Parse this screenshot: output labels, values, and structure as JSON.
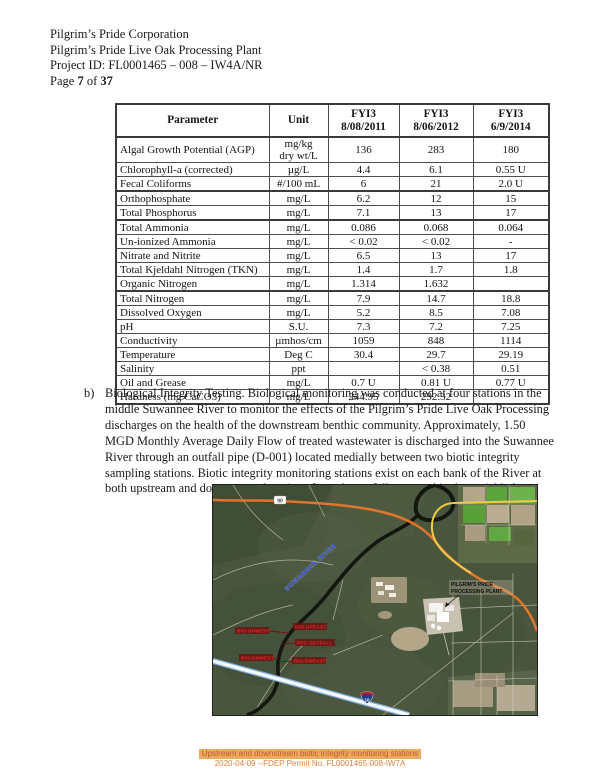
{
  "document": {
    "header_lines": [
      "Pilgrim’s Pride Corporation",
      "Pilgrim’s Pride Live Oak Processing Plant",
      "Project ID: FL0001465 – 008 – IW4A/NR"
    ],
    "page_label": {
      "word_page": "Page",
      "number": "7",
      "word_of": "of",
      "total": "37"
    }
  },
  "table": {
    "columns": [
      {
        "label": "Parameter"
      },
      {
        "label": "Unit"
      },
      {
        "label": "FYI3",
        "sub": "8/08/2011"
      },
      {
        "label": "FYI3",
        "sub": "8/06/2012"
      },
      {
        "label": "FYI3",
        "sub": "6/9/2014"
      }
    ],
    "rows": [
      [
        "Algal Growth Potential (AGP)",
        "mg/kg\ndry wt/L",
        "136",
        "283",
        "180"
      ],
      [
        "Chlorophyll-a (corrected)",
        "µg/L",
        "4.4",
        "6.1",
        "0.55 U"
      ],
      [
        "Fecal Coliforms",
        "#/100 mL",
        "6",
        "21",
        "2.0 U"
      ],
      [
        "Orthophosphate",
        "mg/L",
        "6.2",
        "12",
        "15"
      ],
      [
        "Total Phosphorus",
        "mg/L",
        "7.1",
        "13",
        "17"
      ],
      [
        "Total Ammonia",
        "mg/L",
        "0.086",
        "0.068",
        "0.064"
      ],
      [
        "Un-ionized Ammonia",
        "mg/L",
        "< 0.02",
        "< 0.02",
        "-"
      ],
      [
        "Nitrate and Nitrite",
        "mg/L",
        "6.5",
        "13",
        "17"
      ],
      [
        "Total Kjeldahl Nitrogen (TKN)",
        "mg/L",
        "1.4",
        "1.7",
        "1.8"
      ],
      [
        "Organic Nitrogen",
        "mg/L",
        "1.314",
        "1.632",
        ""
      ],
      [
        "Total Nitrogen",
        "mg/L",
        "7.9",
        "14.7",
        "18.8"
      ],
      [
        "Dissolved Oxygen",
        "mg/L",
        "5.2",
        "8.5",
        "7.08"
      ],
      [
        "pH",
        "S.U.",
        "7.3",
        "7.2",
        "7.25"
      ],
      [
        "Conductivity",
        "µmhos/cm",
        "1059",
        "848",
        "1114"
      ],
      [
        "Temperature",
        "Deg C",
        "30.4",
        "29.7",
        "29.19"
      ],
      [
        "Salinity",
        "ppt",
        "",
        "< 0.38",
        "0.51"
      ],
      [
        "Oil and Grease",
        "mg/L",
        "0.7 U",
        "0.81 U",
        "0.77 U"
      ],
      [
        "Hardness (mg CaCO3)",
        "mg/L",
        "244.95",
        "292.32",
        ""
      ]
    ]
  },
  "body_text": {
    "item_marker": "b)",
    "paragraph": "Biological Integrity Testing.  Biological monitoring was conducted at four stations in the middle Suwannee River to monitor the effects of the Pilgrim’s Pride Live Oak Processing discharges on the health of the downstream benthic community. Approximately, 1.50 MGD Monthly Average Daily Flow of treated wastewater is discharged into the Suwannee River through an outfall pipe (D-001) located medially between two biotic integrity sampling stations. Biotic integrity monitoring stations exist on each bank of the River at both upstream and downstream locations from the outfall, as noted in the aerial below."
  },
  "map": {
    "river_label": "SUWANNEE RIVER",
    "plant_label_line1": "PILGRIM'S PRIDE",
    "plant_label_line2": "PROCESSING PLANT",
    "route_us90": "90",
    "route_i10": "10",
    "stations": [
      {
        "label": "BIO-UPWEST"
      },
      {
        "label": "BIO-UPEAST"
      },
      {
        "label": "PPC OUTFALL"
      },
      {
        "label": "BIO-DNWEST"
      },
      {
        "label": "BIO-DNEAST"
      }
    ]
  },
  "caption": {
    "line1": "Upstream and downstream biotic integrity monitoring stations",
    "line2": "2020-04-09 --FDEP Permit No. FL0001465-008-IW7A"
  },
  "colors": {
    "caption_highlight": "#edaa5e",
    "caption_text": "#bc5a2c",
    "station_label_red": "#ee2222",
    "river_label_blue": "#2946d2",
    "road_orange": "#e0752e",
    "road_yellow": "#eace4a",
    "interstate_blue": "#1e3e8e"
  }
}
